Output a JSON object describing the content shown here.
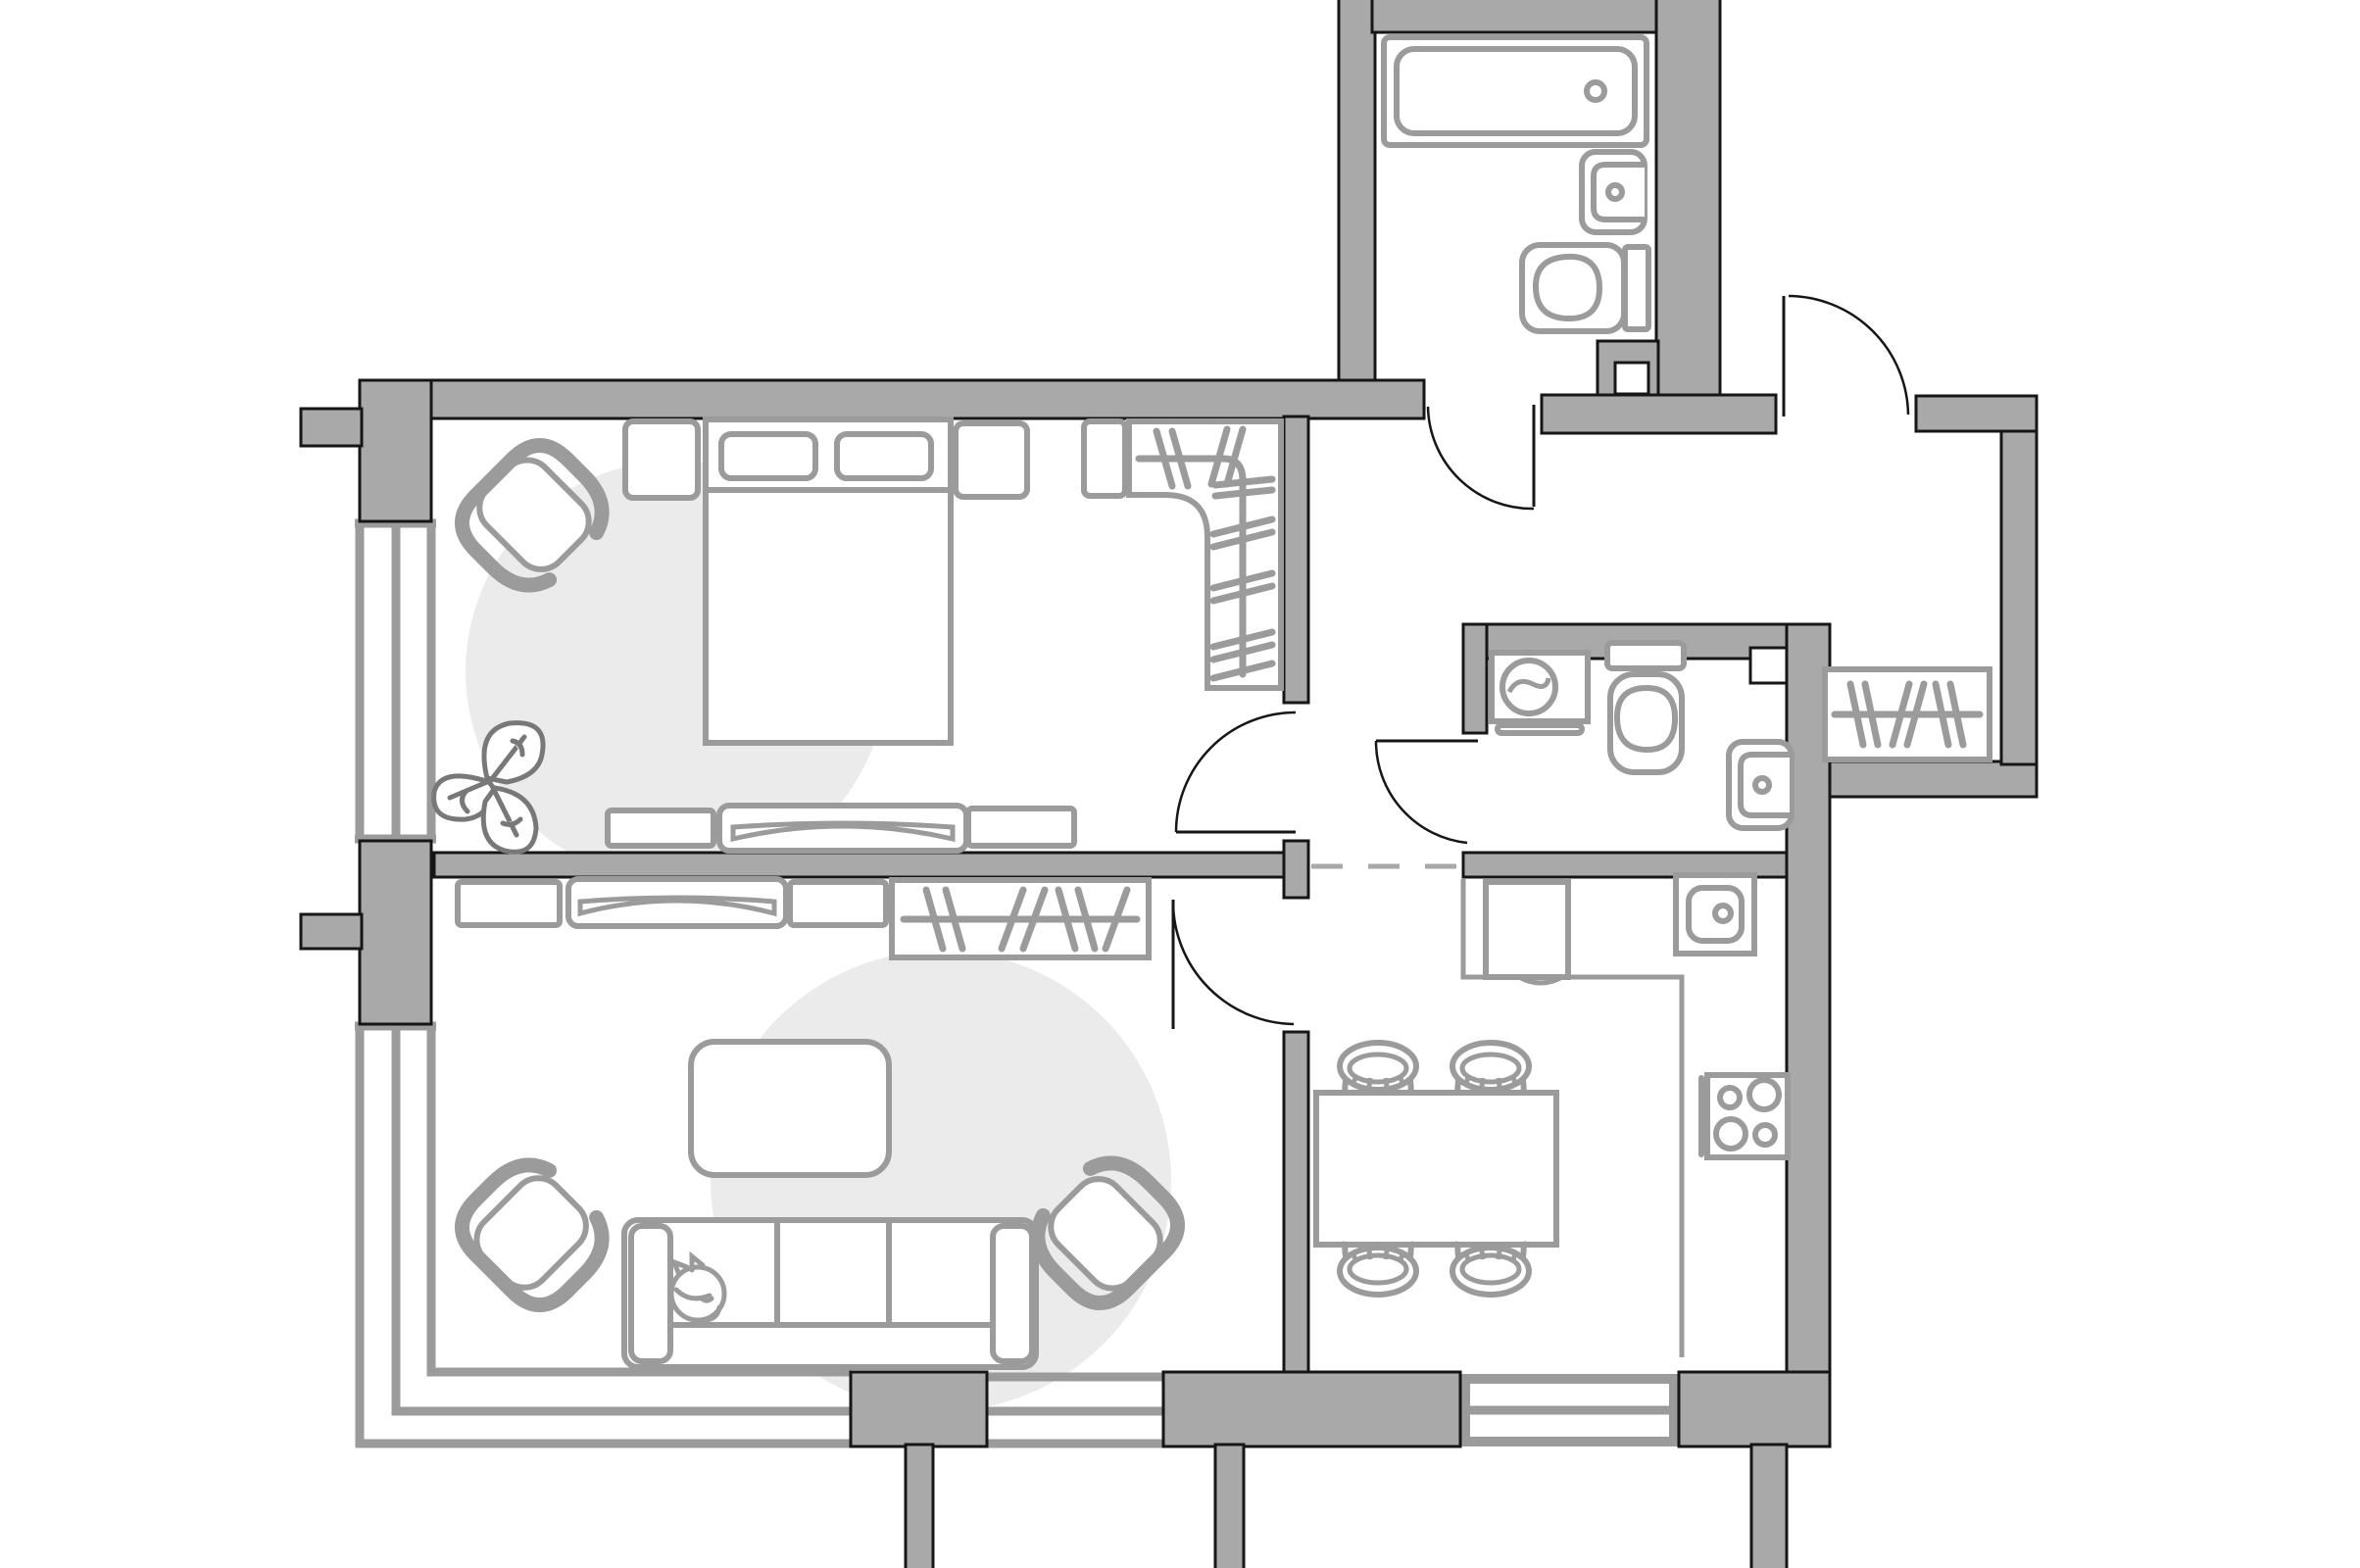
{
  "meta": {
    "title": "Apartment floor plan drawing"
  },
  "colors": {
    "bg": "#ffffff",
    "wall": "#a9a9a9",
    "outline": "#161616",
    "line": "#9b9b9b",
    "accent": "#ebebeb",
    "plant": "#787878"
  },
  "rooms": [
    {
      "id": "bedroom",
      "furniture": [
        "double-bed",
        "pillows",
        "nightstand-left",
        "nightstand-right",
        "corner-wardrobe",
        "armchair",
        "monstera-plant",
        "tv-stand-row",
        "window"
      ]
    },
    {
      "id": "living-room",
      "furniture": [
        "sofa",
        "sleeping-cat",
        "coffee-table",
        "armchair-left",
        "armchair-right",
        "tv-stand-row",
        "wardrobe-shelf",
        "window"
      ]
    },
    {
      "id": "kitchen",
      "furniture": [
        "counter",
        "fridge-cabinet",
        "kitchen-sink",
        "hob-4-burners",
        "dining-table",
        "stool-1",
        "stool-2",
        "stool-3",
        "stool-4",
        "window"
      ]
    },
    {
      "id": "bathroom",
      "furniture": [
        "bathtub",
        "wash-basin",
        "toilet"
      ]
    },
    {
      "id": "wc",
      "furniture": [
        "washing-machine",
        "toilet",
        "wash-basin"
      ]
    },
    {
      "id": "hallway",
      "furniture": [
        "entry-door",
        "coat-rack"
      ]
    }
  ],
  "doors": [
    "entry-door",
    "bathroom-door",
    "wc-door",
    "bedroom-door",
    "living-room-door"
  ],
  "openings": [
    "kitchen-dashed-opening"
  ]
}
